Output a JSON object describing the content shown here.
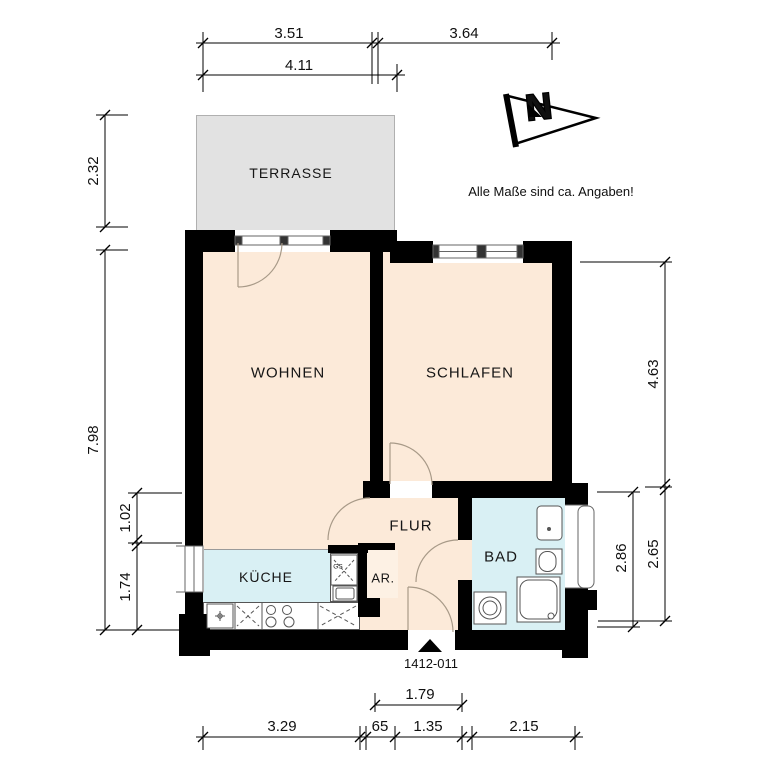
{
  "annotations": {
    "disclaimer": "Alle Maße sind ca. Angaben!",
    "plan_number": "1412-011",
    "north_letter": "N"
  },
  "rooms": {
    "terrasse": {
      "label": "TERRASSE"
    },
    "wohnen": {
      "label": "WOHNEN"
    },
    "schlafen": {
      "label": "SCHLAFEN"
    },
    "flur": {
      "label": "FLUR"
    },
    "kueche": {
      "label": "KÜCHE"
    },
    "abstellraum": {
      "label": "AR."
    },
    "bad": {
      "label": "BAD"
    },
    "geschirrspueler": {
      "label": "GS"
    }
  },
  "dimensions": {
    "top": {
      "d1": "3.51",
      "d2": "3.64",
      "d3": "4.11"
    },
    "left": {
      "d1": "2.32",
      "d2": "7.98",
      "d3": "1.02",
      "d4": "1.74"
    },
    "right": {
      "d1": "4.63",
      "d2": "2.86",
      "d3": "2.65"
    },
    "bottom": {
      "d1": "1.79",
      "d2": "3.29",
      "d3": "65",
      "d4": "1.35",
      "d5": "2.15"
    }
  },
  "colors": {
    "wall": "#000000",
    "room_fill": "#fcead9",
    "wet_room_fill": "#d9f0f4",
    "terrace_fill": "#e2e2e2",
    "door_arc": "#a89a88"
  }
}
